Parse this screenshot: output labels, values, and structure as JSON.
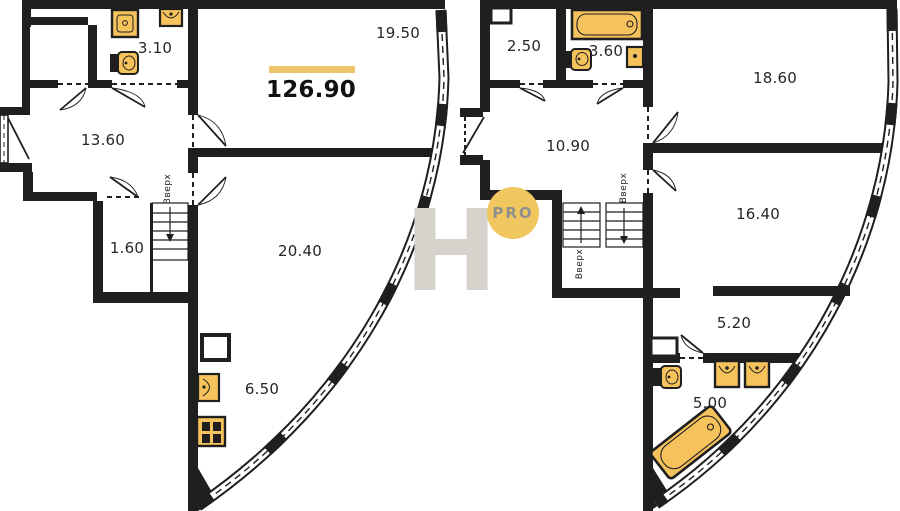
{
  "watermark": {
    "letter": "H",
    "badge": "PRO"
  },
  "stairs": {
    "label": "Вверх"
  },
  "colors": {
    "wall": "#1f1f1f",
    "fixture_fill": "#F6C25C",
    "accent_bar": "#F0C468",
    "badge_circle": "#F0C75E",
    "watermark_gray": "#D6D2CC"
  },
  "floor1": {
    "total_area": "126.90",
    "rooms": {
      "bathroom": "3.10",
      "living": "19.50",
      "hall": "13.60",
      "wc": "1.60",
      "room": "20.40",
      "kitchen": "6.50"
    }
  },
  "floor2": {
    "rooms": {
      "wardrobe": "2.50",
      "bathroom": "3.60",
      "bedroom1": "18.60",
      "hall": "10.90",
      "bedroom2": "16.40",
      "dressing": "5.20",
      "bathroom2": "5.00"
    }
  }
}
